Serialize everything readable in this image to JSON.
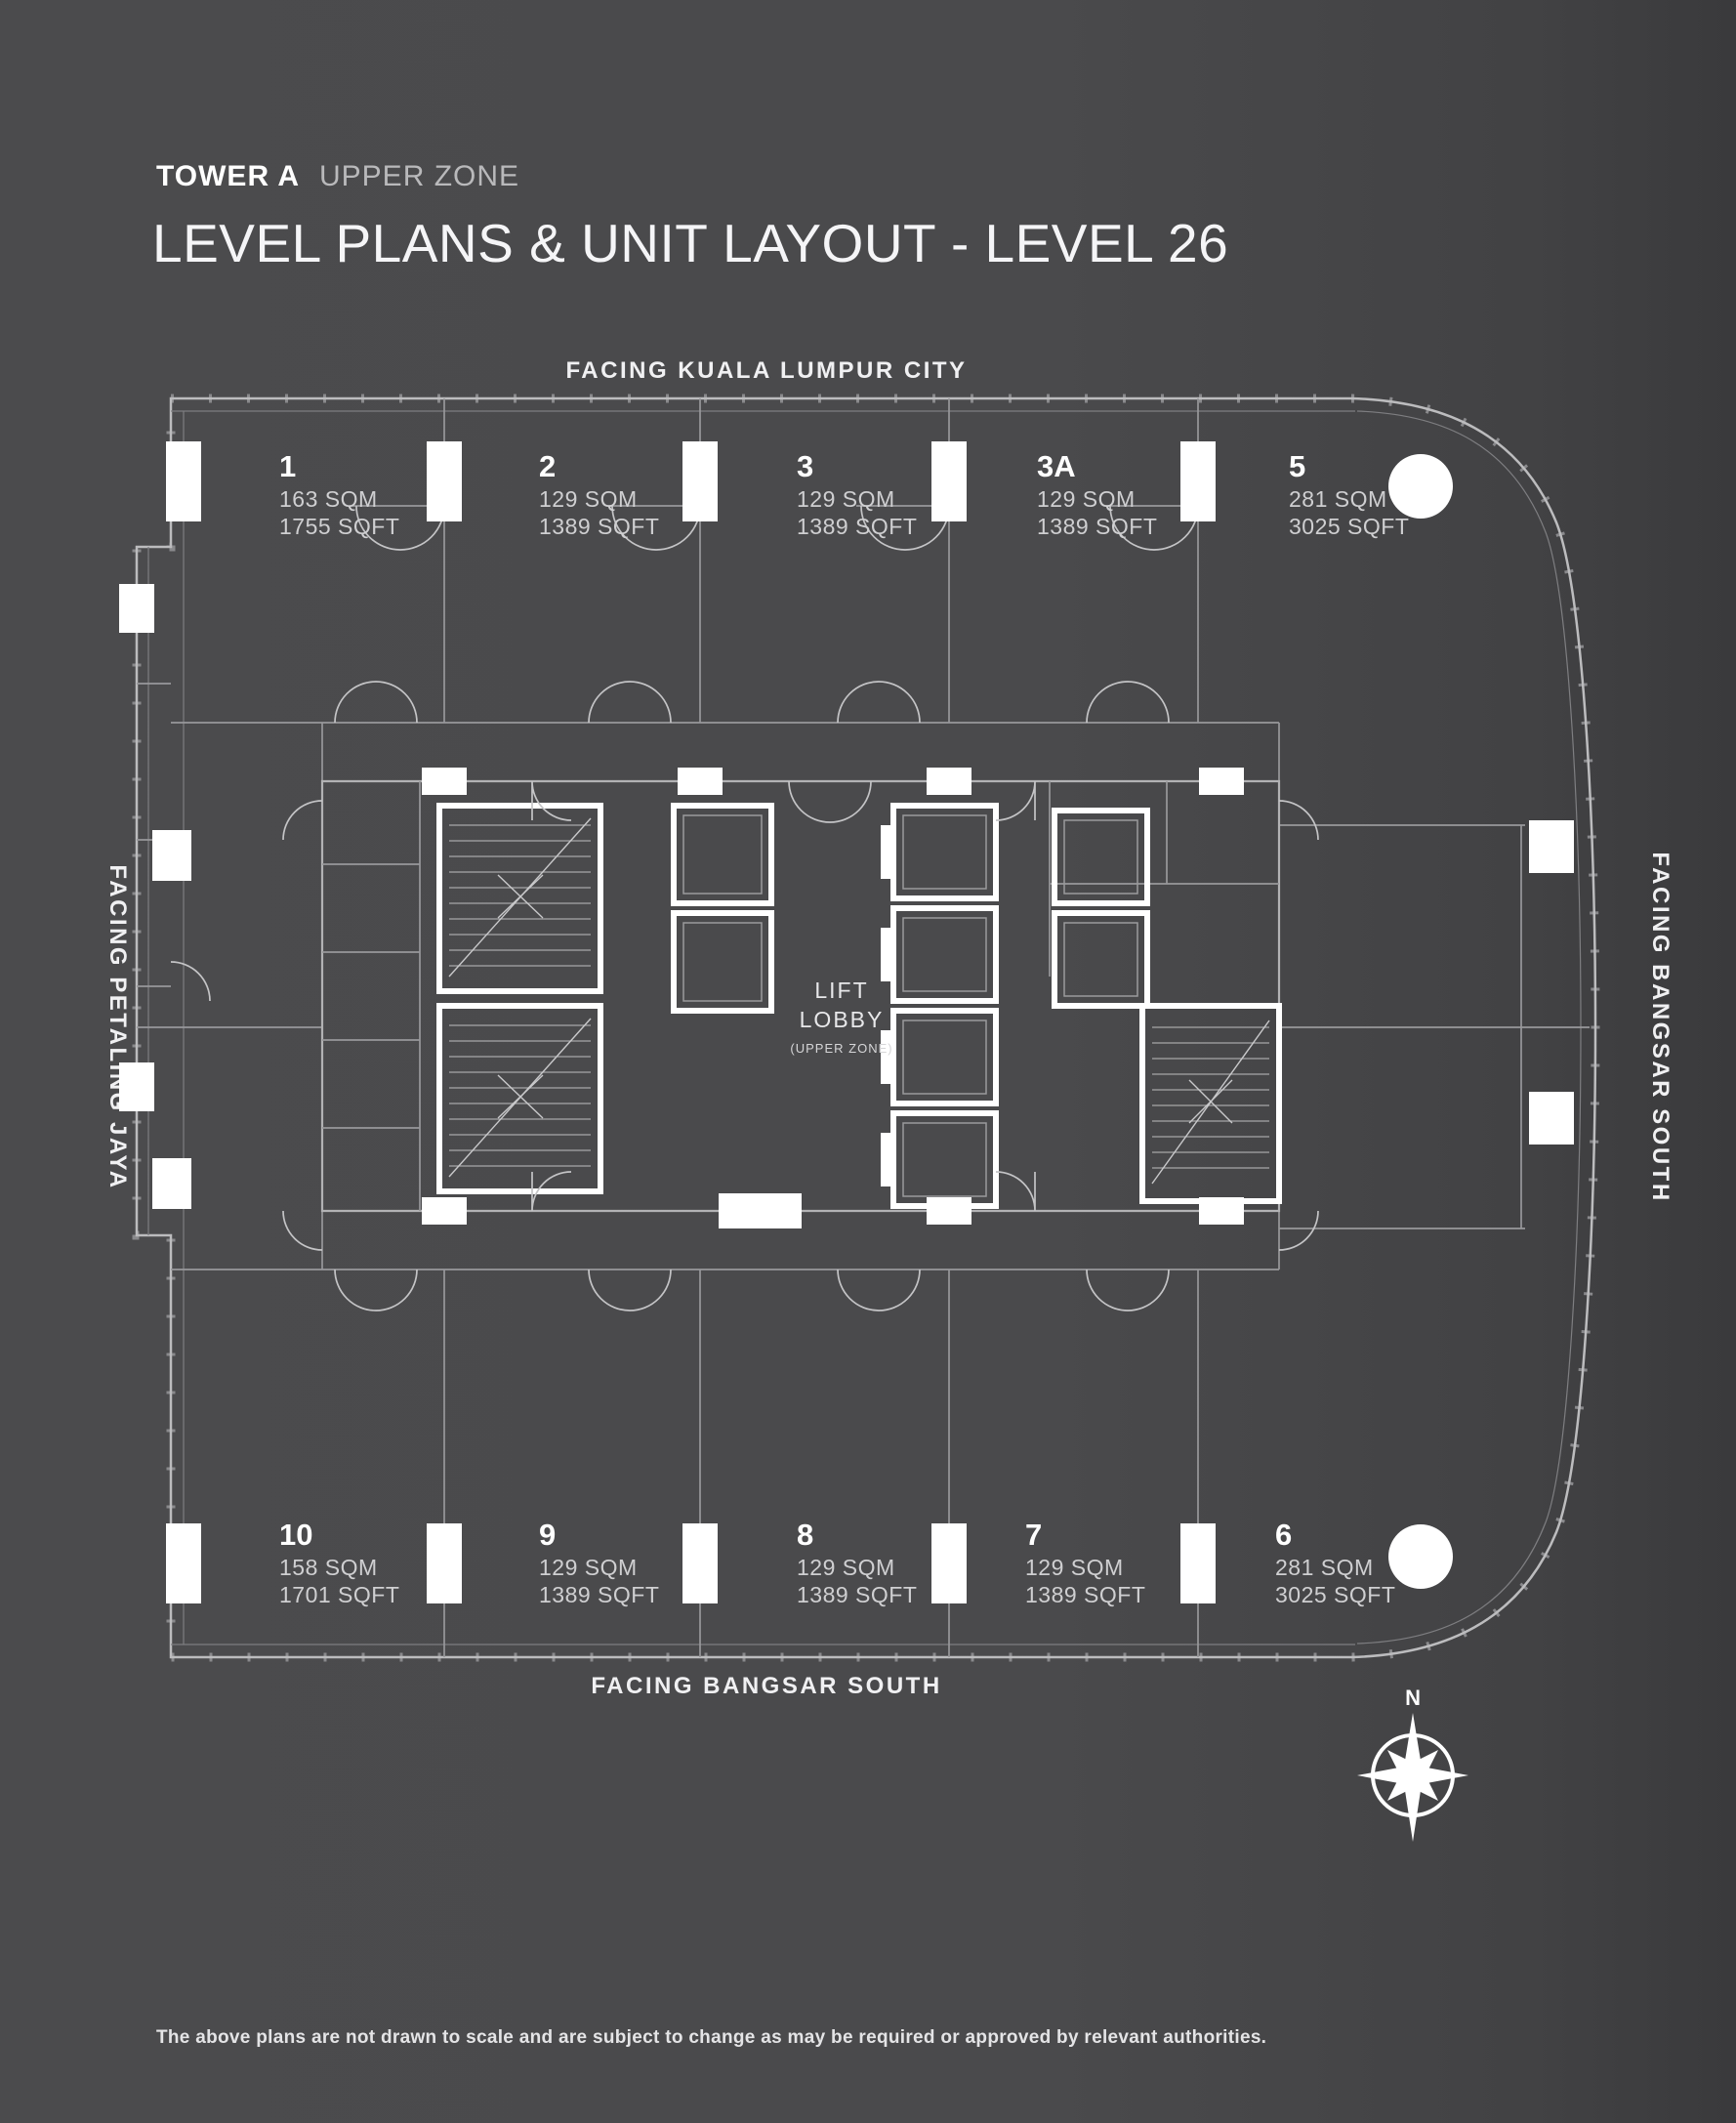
{
  "header": {
    "tower": "TOWER A",
    "zone": "UPPER ZONE",
    "title": "LEVEL PLANS & UNIT LAYOUT - LEVEL 26"
  },
  "facing": {
    "top": "FACING KUALA LUMPUR CITY",
    "bottom": "FACING BANGSAR SOUTH",
    "left": "FACING PETALING JAYA",
    "right": "FACING BANGSAR SOUTH"
  },
  "core": {
    "lift_lobby_line1": "LIFT",
    "lift_lobby_line2": "LOBBY",
    "lift_lobby_line3": "(UPPER ZONE)"
  },
  "compass": {
    "north_label": "N"
  },
  "units": {
    "top": [
      {
        "id": "1",
        "sqm": "163 SQM",
        "sqft": "1755 SQFT"
      },
      {
        "id": "2",
        "sqm": "129 SQM",
        "sqft": "1389 SQFT"
      },
      {
        "id": "3",
        "sqm": "129 SQM",
        "sqft": "1389 SQFT"
      },
      {
        "id": "3A",
        "sqm": "129 SQM",
        "sqft": "1389 SQFT"
      },
      {
        "id": "5",
        "sqm": "281 SQM",
        "sqft": "3025 SQFT"
      }
    ],
    "bottom": [
      {
        "id": "10",
        "sqm": "158 SQM",
        "sqft": "1701 SQFT"
      },
      {
        "id": "9",
        "sqm": "129 SQM",
        "sqft": "1389 SQFT"
      },
      {
        "id": "8",
        "sqm": "129 SQM",
        "sqft": "1389 SQFT"
      },
      {
        "id": "7",
        "sqm": "129 SQM",
        "sqft": "1389 SQFT"
      },
      {
        "id": "6",
        "sqm": "281 SQM",
        "sqft": "3025 SQFT"
      }
    ]
  },
  "footer": {
    "disclaimer": "The above plans are not drawn to scale and are subject to change as may be required or approved by relevant authorities."
  },
  "colors": {
    "background": "#4a4a4c",
    "plan_line": "#9a9a9c",
    "highlight": "#ffffff"
  }
}
